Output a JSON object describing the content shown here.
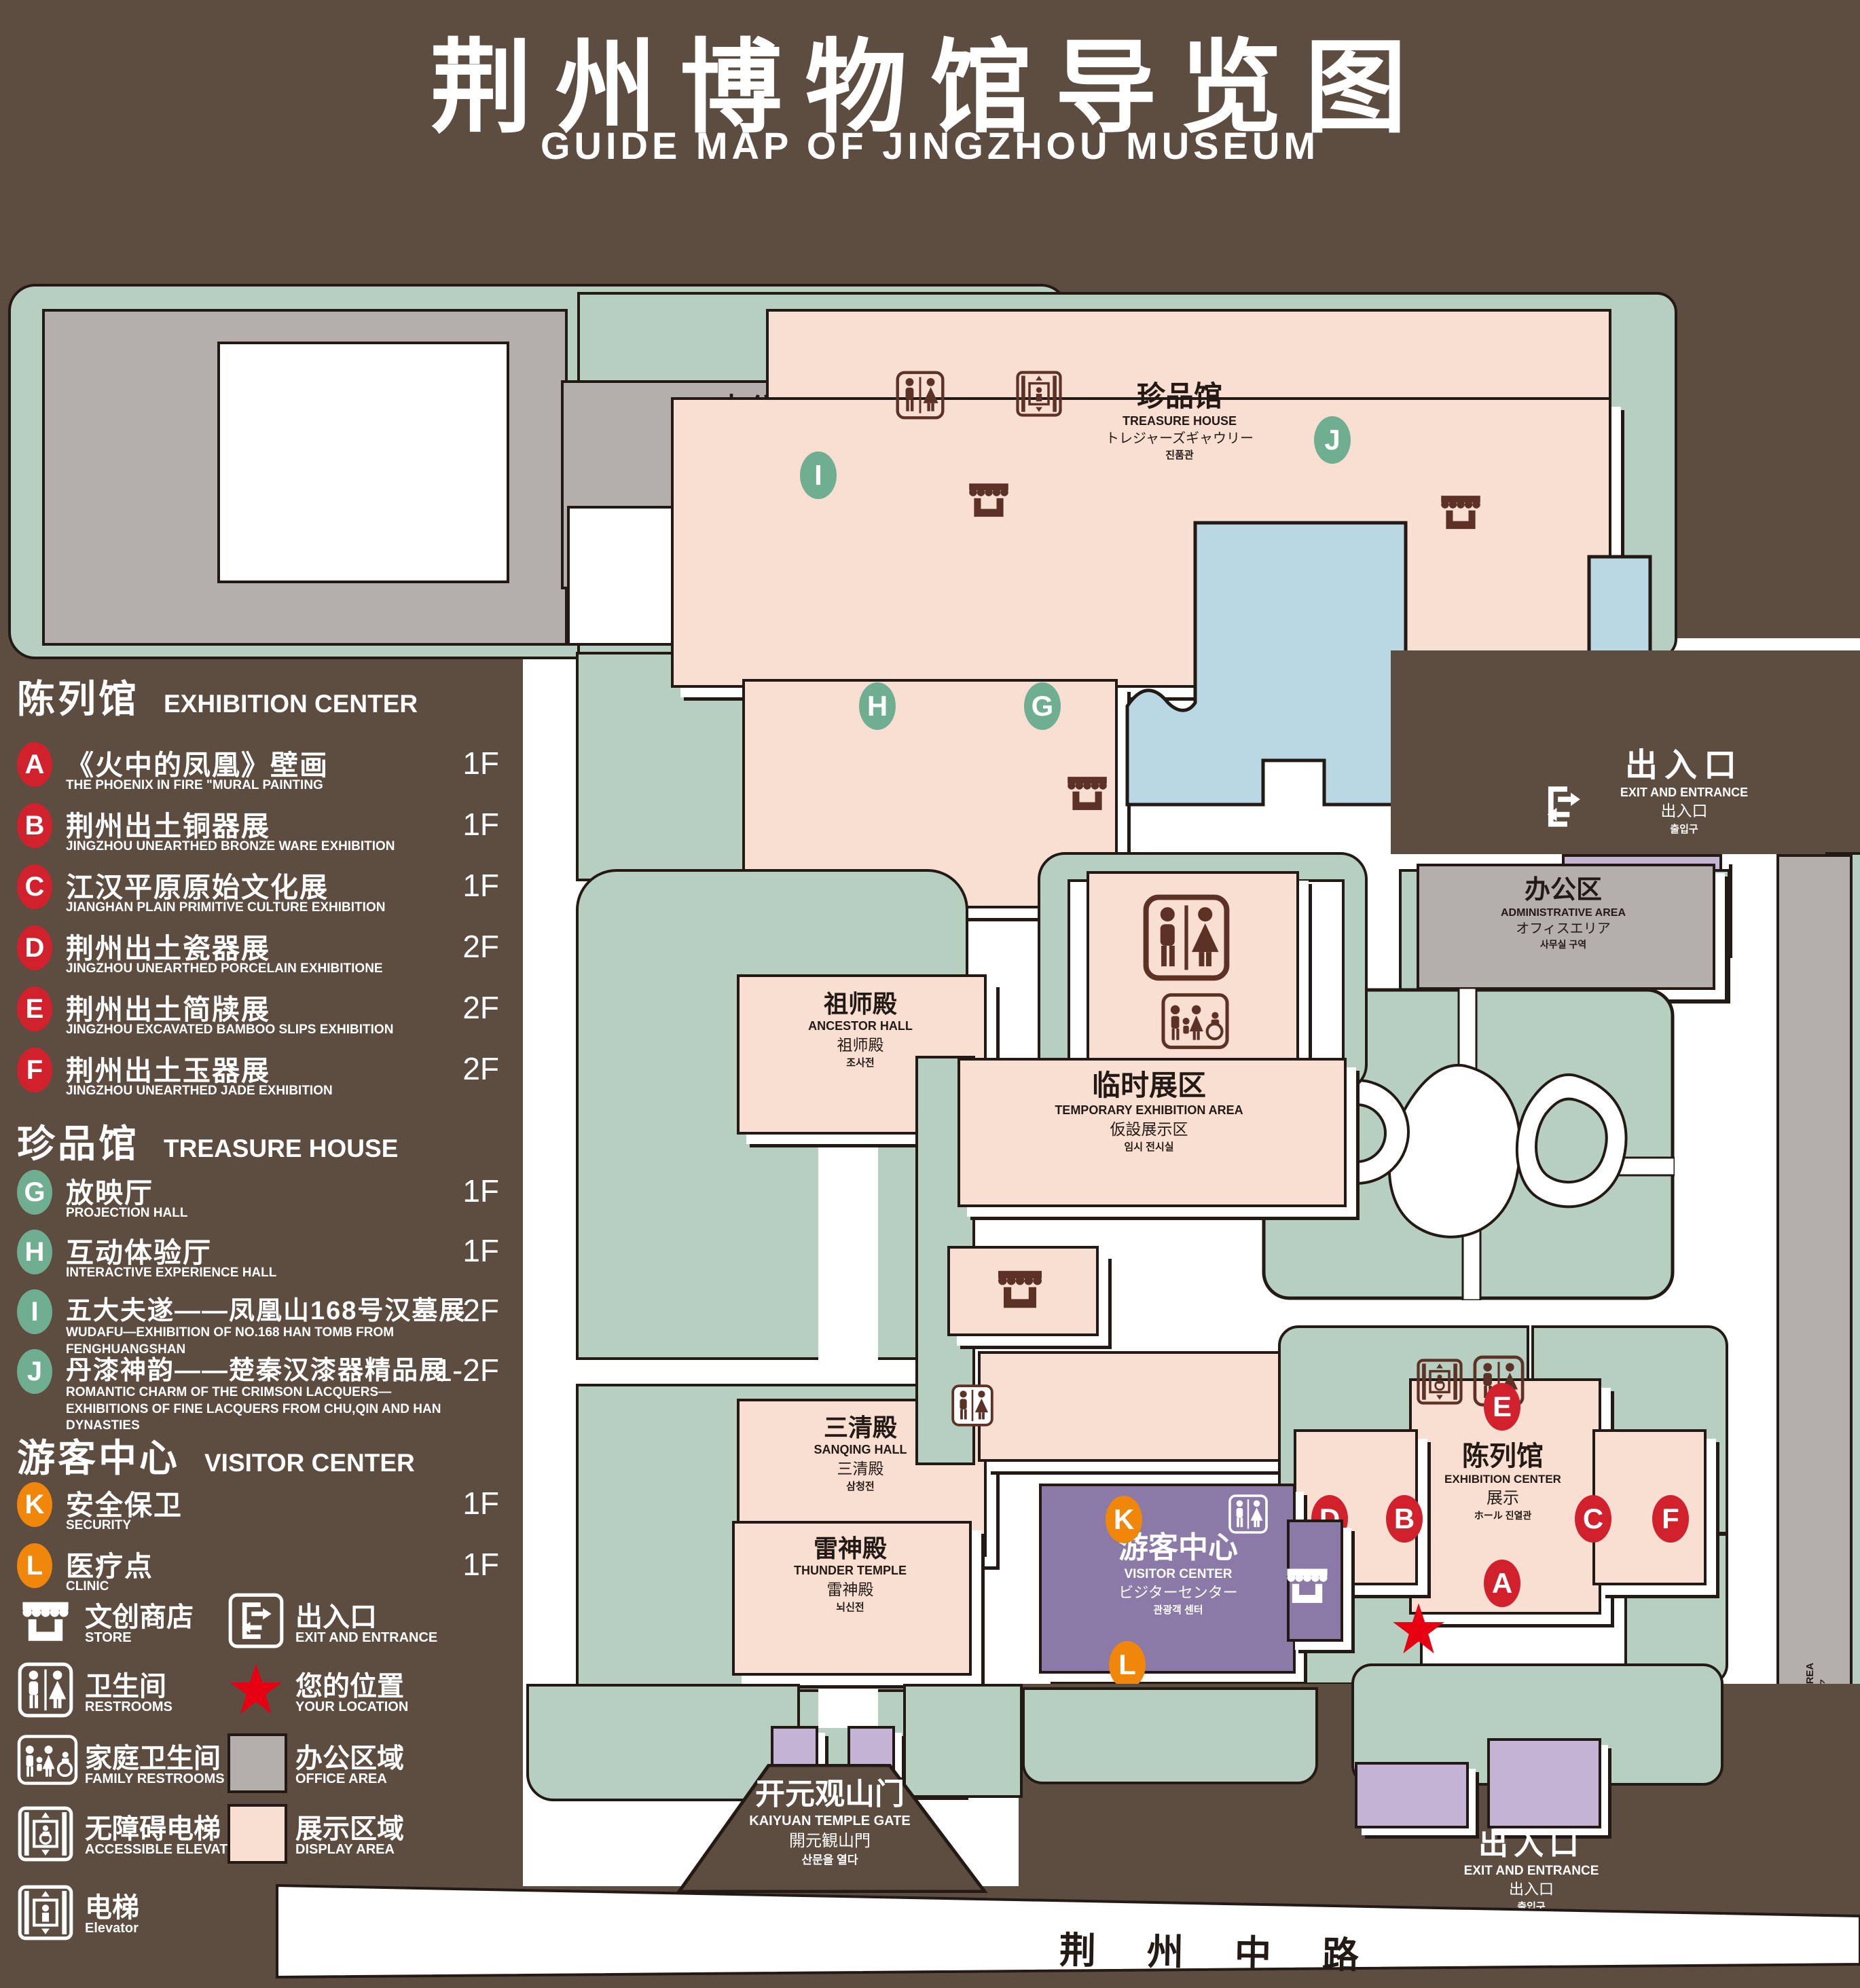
{
  "colors": {
    "background": "#5d4c40",
    "park_green": "#b7cfc1",
    "display_pink": "#f9dfd2",
    "office_gray": "#b4afac",
    "pond_blue": "#b9d8e4",
    "visitor_purple": "#8b7aa8",
    "entrance_purple": "#c5b3d6",
    "badge_red": "#d0212d",
    "badge_green": "#6fae90",
    "badge_orange": "#f0860a",
    "outline": "#241a15",
    "icon_brown": "#5c3226",
    "location_red": "#e60012"
  },
  "title": {
    "cn": "荆州博物馆导览图",
    "en": "GUIDE MAP OF JINGZHOU MUSEUM"
  },
  "legend": {
    "sections": [
      {
        "cn": "陈列馆",
        "en": "EXHIBITION CENTER",
        "items": [
          {
            "code": "A",
            "cn": "《火中的凤凰》壁画",
            "en": "THE PHOENIX IN FIRE \"MURAL PAINTING",
            "floor": "1F"
          },
          {
            "code": "B",
            "cn": "荆州出土铜器展",
            "en": "JINGZHOU UNEARTHED BRONZE WARE EXHIBITION",
            "floor": "1F"
          },
          {
            "code": "C",
            "cn": "江汉平原原始文化展",
            "en": "JIANGHAN PLAIN PRIMITIVE CULTURE EXHIBITION",
            "floor": "1F"
          },
          {
            "code": "D",
            "cn": "荆州出土瓷器展",
            "en": "JINGZHOU UNEARTHED PORCELAIN EXHIBITIONE",
            "floor": "2F"
          },
          {
            "code": "E",
            "cn": "荆州出土简牍展",
            "en": "JINGZHOU EXCAVATED BAMBOO SLIPS EXHIBITION",
            "floor": "2F"
          },
          {
            "code": "F",
            "cn": "荆州出土玉器展",
            "en": "JINGZHOU UNEARTHED JADE EXHIBITION",
            "floor": "2F"
          }
        ]
      },
      {
        "cn": "珍品馆",
        "en": "TREASURE HOUSE",
        "items": [
          {
            "code": "G",
            "cn": "放映厅",
            "en": "PROJECTION HALL",
            "floor": "1F"
          },
          {
            "code": "H",
            "cn": "互动体验厅",
            "en": "INTERACTIVE EXPERIENCE HALL",
            "floor": "1F"
          },
          {
            "code": "I",
            "cn": "五大夫遂——凤凰山168号汉墓展",
            "en": "WUDAFU—EXHIBITION OF NO.168 HAN TOMB FROM FENGHUANGSHAN",
            "floor": "2F"
          },
          {
            "code": "J",
            "cn": "丹漆神韵——楚秦汉漆器精品展",
            "en": "ROMANTIC CHARM OF THE CRIMSON LACQUERS—EXHIBITIONS OF FINE LACQUERS FROM CHU,QIN AND HAN DYNASTIES",
            "floor": "1-2F"
          }
        ]
      },
      {
        "cn": "游客中心",
        "en": "VISITOR CENTER",
        "items": [
          {
            "code": "K",
            "cn": "安全保卫",
            "en": "SECURITY",
            "floor": "1F"
          },
          {
            "code": "L",
            "cn": "医疗点",
            "en": "CLINIC",
            "floor": "1F"
          }
        ]
      }
    ],
    "symbols": [
      {
        "icon": "store-icon",
        "cn": "文创商店",
        "en": "STORE"
      },
      {
        "icon": "exit-icon",
        "cn": "出入口",
        "en": "EXIT AND ENTRANCE"
      },
      {
        "icon": "restroom-icon",
        "cn": "卫生间",
        "en": "RESTROOMS"
      },
      {
        "icon": "location-star-icon",
        "cn": "您的位置",
        "en": "YOUR LOCATION"
      },
      {
        "icon": "family-restroom-icon",
        "cn": "家庭卫生间",
        "en": "FAMILY RESTROOMS"
      },
      {
        "icon": "office-area-swatch",
        "cn": "办公区域",
        "en": "OFFICE AREA"
      },
      {
        "icon": "accessible-elevator-icon",
        "cn": "无障碍电梯",
        "en": "ACCESSIBLE ELEVATOR"
      },
      {
        "icon": "display-area-swatch",
        "cn": "展示区域",
        "en": "DISPLAY AREA"
      },
      {
        "icon": "elevator-icon",
        "cn": "电梯",
        "en": "Elevator"
      }
    ]
  },
  "map": {
    "admin": {
      "l1": "办公区",
      "l2": "ADMINISTRATIVE AREA",
      "l3": "オフィスエリア",
      "l4": "사무실 구역"
    },
    "treasure": {
      "l1": "珍品馆",
      "l2": "TREASURE HOUSE",
      "l3": "トレジャーズギャウリー",
      "l4": "진품관"
    },
    "ancestor": {
      "l1": "祖师殿",
      "l2": "ANCESTOR HALL",
      "l3": "祖师殿",
      "l4": "조사전"
    },
    "sanqing": {
      "l1": "三清殿",
      "l2": "SANQING HALL",
      "l3": "三清殿",
      "l4": "삼청전"
    },
    "thunder": {
      "l1": "雷神殿",
      "l2": "THUNDER TEMPLE",
      "l3": "雷神殿",
      "l4": "뇌신전"
    },
    "temporary": {
      "l1": "临时展区",
      "l2": "TEMPORARY EXHIBITION AREA",
      "l3": "仮設展示区",
      "l4": "임시 전시실"
    },
    "exhibition": {
      "l1": "陈列馆",
      "l2": "EXHIBITION CENTER",
      "l3": "展示",
      "l4": "ホール 진열관"
    },
    "visitor": {
      "l1": "游客中心",
      "l2": "VISITOR CENTER",
      "l3": "ビジターセンター",
      "l4": "관광객 센터"
    },
    "gate": {
      "l1": "开元观山门",
      "l2": "KAIYUAN TEMPLE GATE",
      "l3": "開元観山門",
      "l4": "산문을 열다"
    },
    "exit": {
      "l1": "出入口",
      "l2": "EXIT AND ENTRANCE",
      "l3": "出入口",
      "l4": "출입구"
    },
    "your_location": "您的位置",
    "road": "荆 州 中 路",
    "badges": {
      "a": "A",
      "b": "B",
      "c": "C",
      "d": "D",
      "e": "E",
      "f": "F",
      "g": "G",
      "h": "H",
      "i": "I",
      "j": "J",
      "k": "K",
      "l": "L"
    }
  }
}
